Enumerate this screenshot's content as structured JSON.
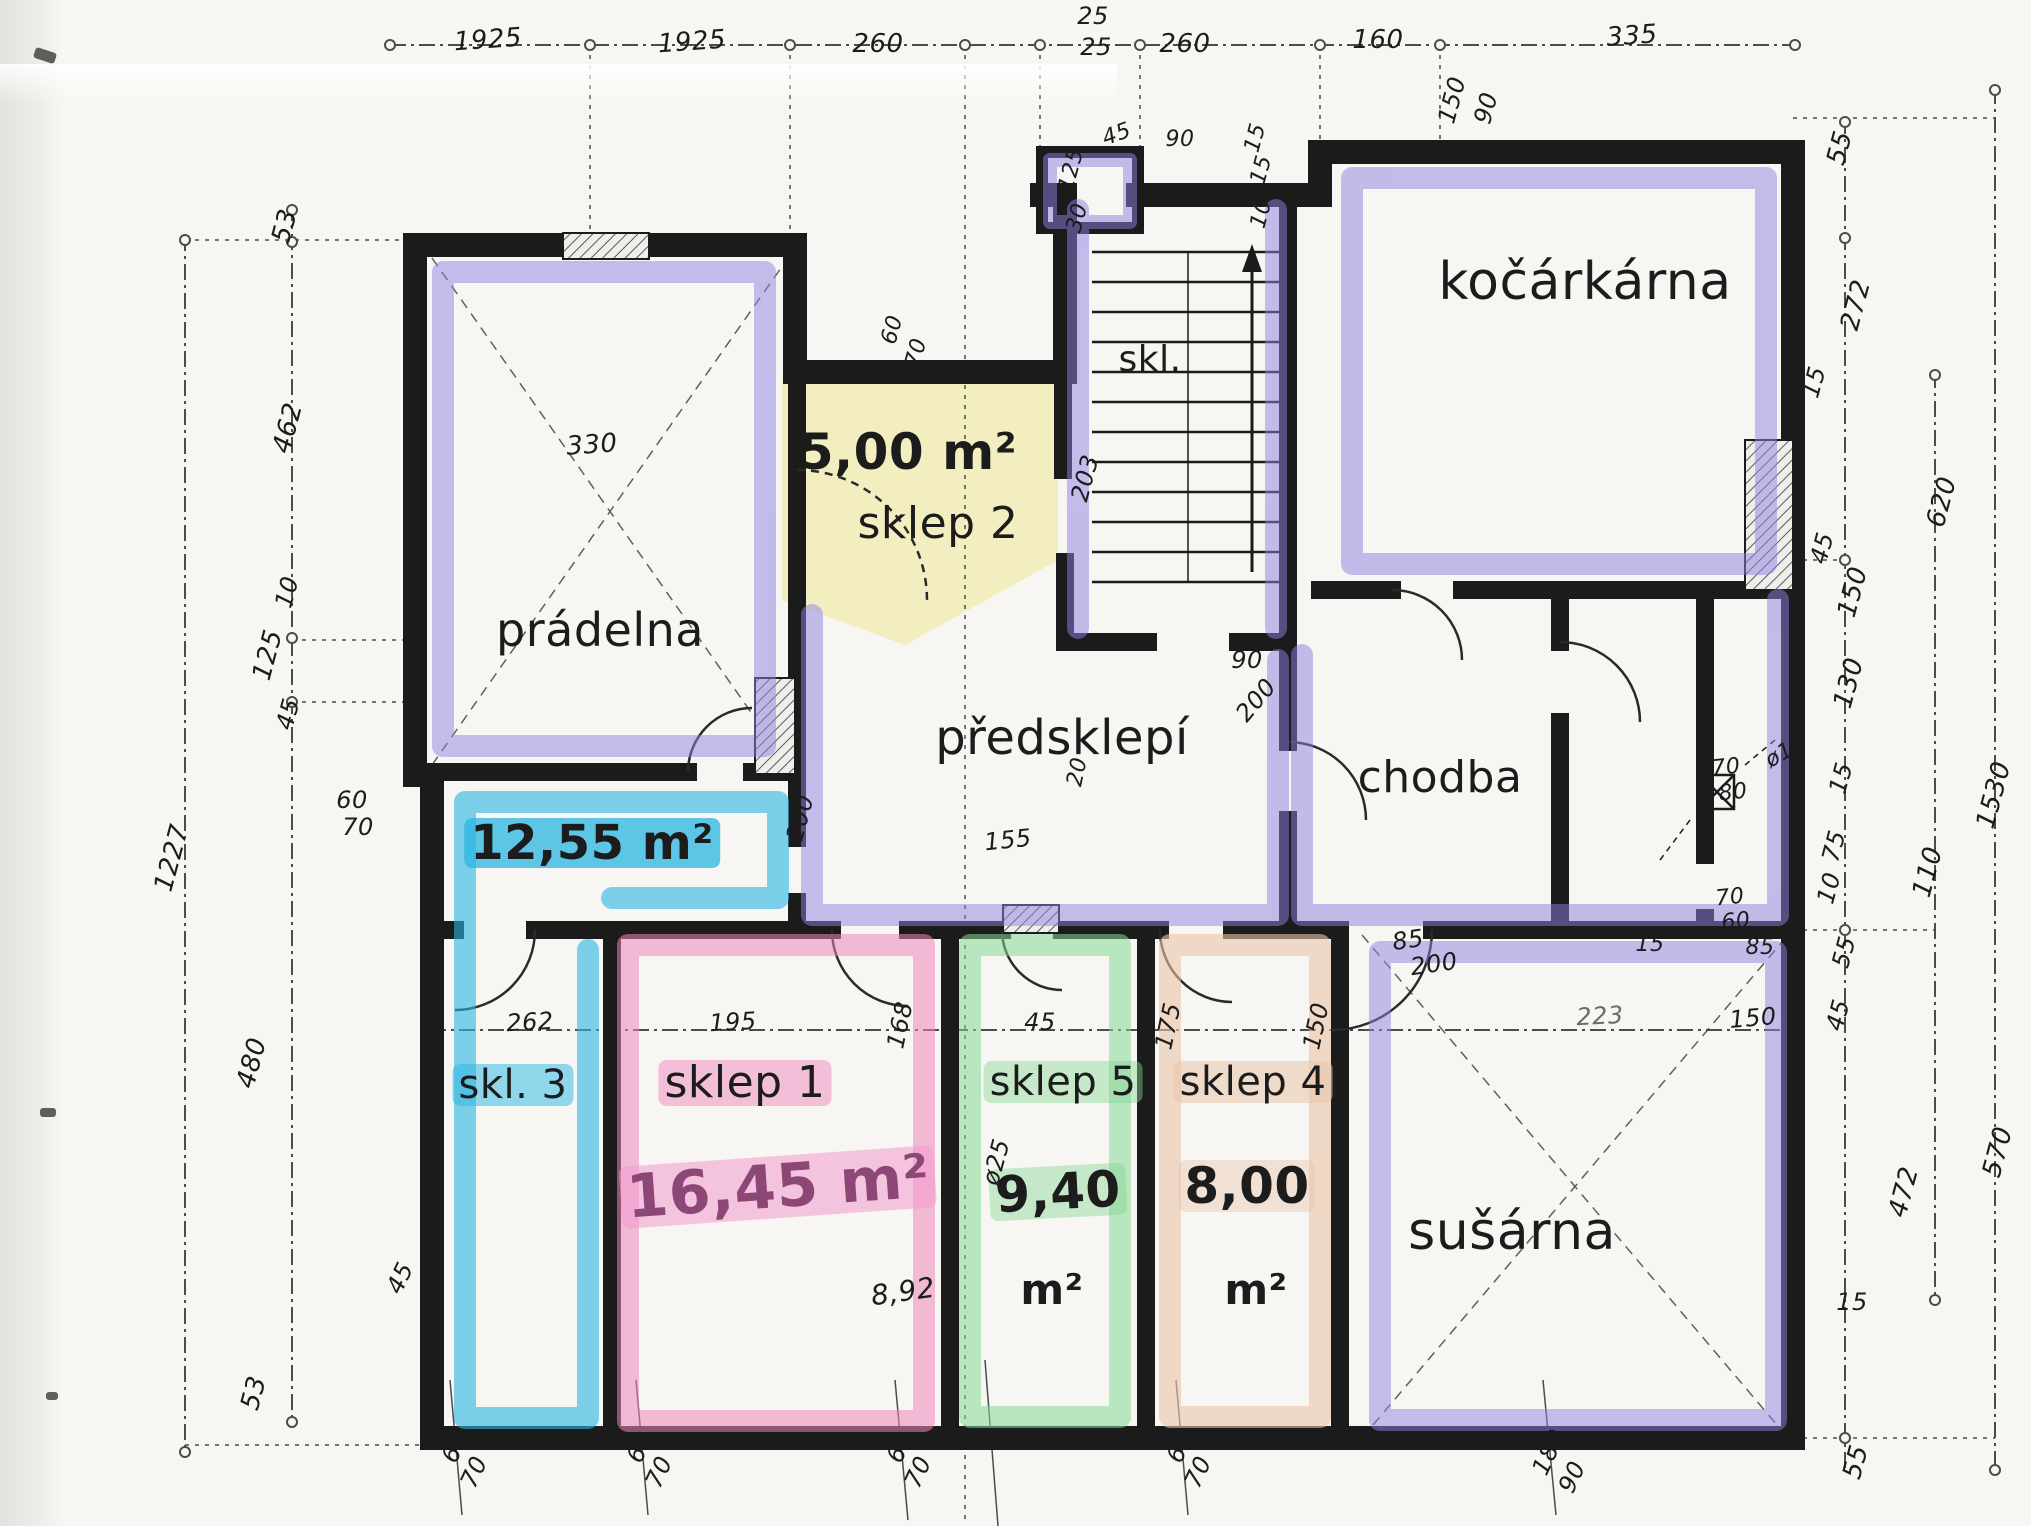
{
  "meta": {
    "kind": "scanned hand-annotated basement floor plan",
    "language_hint": "cs"
  },
  "palette": {
    "ink": "#1c1c1c",
    "paper": "#f7f6f2",
    "purple": "#8f82e4",
    "cyan": "#2ab5e2",
    "pink": "#ef86bb",
    "green": "#84d895",
    "tan": "#e9c4a9",
    "yellow": "#f2edba",
    "marker_magenta": "#8d4777"
  },
  "canvas": {
    "width": 2031,
    "height": 1526
  },
  "rooms": [
    {
      "name": "prádelna"
    },
    {
      "name": "sklep 2",
      "area": "5,00 m²"
    },
    {
      "name": "skl."
    },
    {
      "name": "kočárkárna"
    },
    {
      "name": "předsklepí"
    },
    {
      "name": "chodba"
    },
    {
      "name": "skl. 3",
      "area": "12,55 m²"
    },
    {
      "name": "sklep 1",
      "area": "16,45 m²"
    },
    {
      "name": "sklep 5",
      "area": "9,40 m²"
    },
    {
      "name": "sklep 4",
      "area": "8,00 m²"
    },
    {
      "name": "sušárna"
    }
  ],
  "dimension_chains": {
    "top": [
      "1925",
      "1925",
      "260",
      "25",
      "25",
      "260",
      "160",
      "335",
      "150",
      "90"
    ],
    "left": [
      "53",
      "462",
      "10",
      "125",
      "45",
      "480",
      "53"
    ],
    "left_total": "1227",
    "sklep_row": [
      "262",
      "195",
      "168",
      "45",
      "175",
      "150",
      "223",
      "150"
    ],
    "right_inner": [
      "55",
      "272",
      "15",
      "45",
      "150",
      "130",
      "15",
      "75",
      "10",
      "55",
      "45",
      "15",
      "55"
    ],
    "right_outer": [
      "620",
      "110",
      "1530",
      "570",
      "472"
    ],
    "bottom": [
      "60/70",
      "60/70",
      "60/70",
      "60/70",
      "180/90"
    ]
  },
  "labels": [
    {
      "t": "prádelna",
      "x": 600,
      "y": 630,
      "s": 46,
      "n": "room-pradelna"
    },
    {
      "t": "5,00 m²",
      "x": 908,
      "y": 452,
      "s": 50,
      "b": 1,
      "n": "area-sklep2"
    },
    {
      "t": "sklep 2",
      "x": 938,
      "y": 524,
      "s": 44,
      "n": "room-sklep2"
    },
    {
      "t": "skl.",
      "x": 1150,
      "y": 360,
      "s": 36,
      "n": "room-skl"
    },
    {
      "t": "kočárkárna",
      "x": 1585,
      "y": 282,
      "s": 52,
      "n": "room-kocarkarna"
    },
    {
      "t": "předsklepí",
      "x": 1062,
      "y": 738,
      "s": 48,
      "n": "room-predsklepi"
    },
    {
      "t": "chodba",
      "x": 1440,
      "y": 778,
      "s": 44,
      "n": "room-chodba"
    },
    {
      "t": "12,55 m²",
      "x": 592,
      "y": 843,
      "s": 48,
      "b": 1,
      "bg": "rgba(42,181,226,.75)",
      "n": "area-skl3"
    },
    {
      "t": "skl. 3",
      "x": 513,
      "y": 1085,
      "s": 40,
      "bg": "rgba(42,181,226,.5)",
      "n": "room-skl3"
    },
    {
      "t": "sklep 1",
      "x": 745,
      "y": 1083,
      "s": 44,
      "bg": "rgba(239,134,187,.5)",
      "n": "room-sklep1"
    },
    {
      "t": "16,45 m²",
      "x": 778,
      "y": 1187,
      "s": 60,
      "b": 1,
      "r": -4,
      "c": "#8d4777",
      "bg": "rgba(243,155,205,.55)",
      "n": "area-sklep1"
    },
    {
      "t": "sklep 5",
      "x": 1063,
      "y": 1082,
      "s": 40,
      "bg": "rgba(132,216,149,.45)",
      "n": "room-sklep5"
    },
    {
      "t": "9,40",
      "x": 1058,
      "y": 1192,
      "s": 50,
      "b": 1,
      "r": -3,
      "bg": "rgba(132,216,149,.45)",
      "n": "area-sklep5"
    },
    {
      "t": "m²",
      "x": 1052,
      "y": 1290,
      "s": 42,
      "b": 1,
      "n": "area-sklep5-unit"
    },
    {
      "t": "sklep 4",
      "x": 1253,
      "y": 1082,
      "s": 40,
      "bg": "rgba(233,196,169,.55)",
      "n": "room-sklep4"
    },
    {
      "t": "8,00",
      "x": 1247,
      "y": 1186,
      "s": 50,
      "b": 1,
      "bg": "rgba(233,196,169,.4)",
      "n": "area-sklep4"
    },
    {
      "t": "m²",
      "x": 1256,
      "y": 1290,
      "s": 42,
      "b": 1,
      "n": "area-sklep4-unit"
    },
    {
      "t": "sušárna",
      "x": 1512,
      "y": 1232,
      "s": 52,
      "n": "room-susarna"
    },
    {
      "t": "8,92",
      "x": 903,
      "y": 1292,
      "s": 28,
      "r": -8
    },
    {
      "t": "ø25",
      "x": 996,
      "y": 1162,
      "s": 24,
      "r": -75
    },
    {
      "t": "ø10",
      "x": 1786,
      "y": 752,
      "s": 22,
      "r": -30
    },
    {
      "t": "1925",
      "x": 488,
      "y": 40,
      "s": 26,
      "r": -4
    },
    {
      "t": "1925",
      "x": 692,
      "y": 42,
      "s": 26,
      "r": -4
    },
    {
      "t": "260",
      "x": 878,
      "y": 44,
      "s": 26
    },
    {
      "t": "25",
      "x": 1093,
      "y": 16,
      "s": 24
    },
    {
      "t": "25",
      "x": 1096,
      "y": 47,
      "s": 24
    },
    {
      "t": "260",
      "x": 1185,
      "y": 44,
      "s": 26
    },
    {
      "t": "160",
      "x": 1378,
      "y": 40,
      "s": 26
    },
    {
      "t": "335",
      "x": 1632,
      "y": 36,
      "s": 26,
      "r": -4
    },
    {
      "t": "150",
      "x": 1452,
      "y": 100,
      "s": 24,
      "r": -75
    },
    {
      "t": "90",
      "x": 1486,
      "y": 108,
      "s": 24,
      "r": -75
    },
    {
      "t": "45",
      "x": 1117,
      "y": 135,
      "s": 22,
      "r": -20
    },
    {
      "t": "90",
      "x": 1180,
      "y": 140,
      "s": 22
    },
    {
      "t": "15",
      "x": 1256,
      "y": 138,
      "s": 22,
      "r": -75
    },
    {
      "t": "125",
      "x": 1072,
      "y": 170,
      "s": 22,
      "r": -75
    },
    {
      "t": "15",
      "x": 1262,
      "y": 170,
      "s": 22,
      "r": -75
    },
    {
      "t": "10",
      "x": 1262,
      "y": 214,
      "s": 22,
      "r": -75
    },
    {
      "t": "30",
      "x": 1078,
      "y": 218,
      "s": 22,
      "r": -75
    },
    {
      "t": "53",
      "x": 285,
      "y": 226,
      "s": 26,
      "r": -75
    },
    {
      "t": "462",
      "x": 288,
      "y": 428,
      "s": 26,
      "r": -75
    },
    {
      "t": "10",
      "x": 287,
      "y": 592,
      "s": 24,
      "r": -75
    },
    {
      "t": "125",
      "x": 268,
      "y": 655,
      "s": 26,
      "r": -75
    },
    {
      "t": "60",
      "x": 352,
      "y": 800,
      "s": 24
    },
    {
      "t": "70",
      "x": 358,
      "y": 827,
      "s": 24
    },
    {
      "t": "45",
      "x": 288,
      "y": 714,
      "s": 24,
      "r": -75
    },
    {
      "t": "480",
      "x": 252,
      "y": 1063,
      "s": 26,
      "r": -75
    },
    {
      "t": "53",
      "x": 254,
      "y": 1393,
      "s": 26,
      "r": -75
    },
    {
      "t": "1227",
      "x": 172,
      "y": 858,
      "s": 26,
      "r": -75
    },
    {
      "t": "45",
      "x": 400,
      "y": 1278,
      "s": 24,
      "r": -65
    },
    {
      "t": "262",
      "x": 530,
      "y": 1022,
      "s": 24,
      "r": -3
    },
    {
      "t": "195",
      "x": 733,
      "y": 1022,
      "s": 24,
      "r": -3
    },
    {
      "t": "168",
      "x": 900,
      "y": 1025,
      "s": 24,
      "r": -78
    },
    {
      "t": "45",
      "x": 1040,
      "y": 1022,
      "s": 24
    },
    {
      "t": "175",
      "x": 1168,
      "y": 1026,
      "s": 24,
      "r": -78
    },
    {
      "t": "150",
      "x": 1316,
      "y": 1026,
      "s": 24,
      "r": -78
    },
    {
      "t": "223",
      "x": 1600,
      "y": 1016,
      "s": 24,
      "r": -3,
      "c": "#6a6a6a"
    },
    {
      "t": "150",
      "x": 1753,
      "y": 1018,
      "s": 24,
      "r": -5
    },
    {
      "t": "330",
      "x": 592,
      "y": 445,
      "s": 26,
      "r": -4
    },
    {
      "t": "203",
      "x": 1085,
      "y": 478,
      "s": 24,
      "r": -75
    },
    {
      "t": "60",
      "x": 893,
      "y": 330,
      "s": 22,
      "r": -75
    },
    {
      "t": "70",
      "x": 917,
      "y": 353,
      "s": 22,
      "r": -75
    },
    {
      "t": "90",
      "x": 1247,
      "y": 660,
      "s": 24
    },
    {
      "t": "200",
      "x": 1256,
      "y": 700,
      "s": 24,
      "r": -50
    },
    {
      "t": "155",
      "x": 1008,
      "y": 840,
      "s": 24,
      "r": -6
    },
    {
      "t": "100",
      "x": 800,
      "y": 818,
      "s": 24,
      "r": -75
    },
    {
      "t": "20",
      "x": 1078,
      "y": 772,
      "s": 22,
      "r": -78
    },
    {
      "t": "85",
      "x": 1408,
      "y": 940,
      "s": 24,
      "r": -8
    },
    {
      "t": "200",
      "x": 1434,
      "y": 964,
      "s": 24,
      "r": -8
    },
    {
      "t": "15",
      "x": 1650,
      "y": 945,
      "s": 22
    },
    {
      "t": "85",
      "x": 1760,
      "y": 948,
      "s": 22
    },
    {
      "t": "70",
      "x": 1726,
      "y": 768,
      "s": 22,
      "r": -6
    },
    {
      "t": "80",
      "x": 1733,
      "y": 793,
      "s": 22,
      "r": -6
    },
    {
      "t": "70",
      "x": 1730,
      "y": 898,
      "s": 22,
      "r": -6
    },
    {
      "t": "60",
      "x": 1736,
      "y": 922,
      "s": 22,
      "r": -6
    },
    {
      "t": "55",
      "x": 1840,
      "y": 148,
      "s": 26,
      "r": -75
    },
    {
      "t": "272",
      "x": 1856,
      "y": 305,
      "s": 26,
      "r": -75
    },
    {
      "t": "15",
      "x": 1814,
      "y": 382,
      "s": 24,
      "r": -75
    },
    {
      "t": "620",
      "x": 1942,
      "y": 502,
      "s": 26,
      "r": -75
    },
    {
      "t": "45",
      "x": 1822,
      "y": 548,
      "s": 24,
      "r": -75
    },
    {
      "t": "150",
      "x": 1853,
      "y": 592,
      "s": 26,
      "r": -75
    },
    {
      "t": "130",
      "x": 1849,
      "y": 683,
      "s": 26,
      "r": -75
    },
    {
      "t": "15",
      "x": 1841,
      "y": 778,
      "s": 24,
      "r": -75
    },
    {
      "t": "75",
      "x": 1834,
      "y": 846,
      "s": 24,
      "r": -75
    },
    {
      "t": "10",
      "x": 1829,
      "y": 888,
      "s": 24,
      "r": -75
    },
    {
      "t": "55",
      "x": 1844,
      "y": 952,
      "s": 24,
      "r": -75
    },
    {
      "t": "45",
      "x": 1838,
      "y": 1015,
      "s": 24,
      "r": -75
    },
    {
      "t": "110",
      "x": 1928,
      "y": 872,
      "s": 26,
      "r": -75
    },
    {
      "t": "1530",
      "x": 1994,
      "y": 795,
      "s": 26,
      "r": -75
    },
    {
      "t": "570",
      "x": 1998,
      "y": 1152,
      "s": 26,
      "r": -75
    },
    {
      "t": "472",
      "x": 1904,
      "y": 1192,
      "s": 26,
      "r": -75
    },
    {
      "t": "15",
      "x": 1852,
      "y": 1302,
      "s": 24
    },
    {
      "t": "55",
      "x": 1856,
      "y": 1462,
      "s": 26,
      "r": -75
    },
    {
      "t": "60",
      "x": 455,
      "y": 1447,
      "s": 24,
      "r": -65
    },
    {
      "t": "70",
      "x": 474,
      "y": 1472,
      "s": 24,
      "r": -65
    },
    {
      "t": "60",
      "x": 640,
      "y": 1447,
      "s": 24,
      "r": -65
    },
    {
      "t": "70",
      "x": 659,
      "y": 1472,
      "s": 24,
      "r": -65
    },
    {
      "t": "60",
      "x": 900,
      "y": 1447,
      "s": 24,
      "r": -65
    },
    {
      "t": "70",
      "x": 918,
      "y": 1472,
      "s": 24,
      "r": -65
    },
    {
      "t": "60",
      "x": 1180,
      "y": 1447,
      "s": 24,
      "r": -65
    },
    {
      "t": "70",
      "x": 1198,
      "y": 1472,
      "s": 24,
      "r": -65
    },
    {
      "t": "180",
      "x": 1549,
      "y": 1452,
      "s": 24,
      "r": -65
    },
    {
      "t": "90",
      "x": 1572,
      "y": 1477,
      "s": 24,
      "r": -65
    }
  ]
}
